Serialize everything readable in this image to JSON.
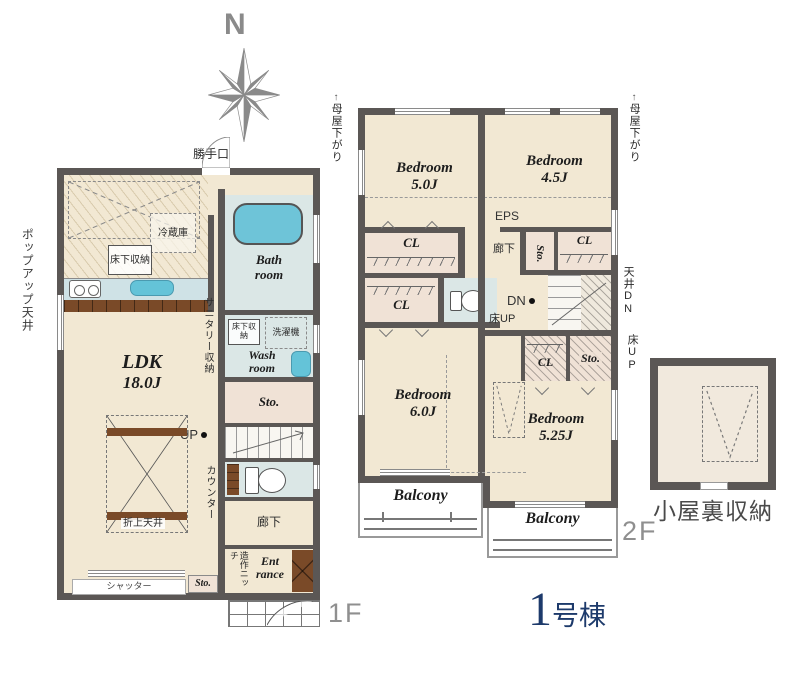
{
  "compass": {
    "north": "N"
  },
  "colors": {
    "wall": "#5b5755",
    "floor_cream": "#f2e8d3",
    "wet_area_blue": "#dbe7e6",
    "tub_blue": "#6ec4d8",
    "storage_beige": "#f0e2d6",
    "wood_brown": "#7a4a28",
    "building_navy": "#1d3a6b",
    "floor_label_gray": "#8f8f8f",
    "compass_gray": "#8a8a8a"
  },
  "floor1": {
    "floor_label": "1F",
    "kitchen": {
      "back_door": "勝手口",
      "refrigerator": "冷蔵庫",
      "underfloor_storage": "床下収納",
      "popup_ceiling": "ポップアップ天井"
    },
    "bath": {
      "line1": "Bath",
      "line2": "room"
    },
    "wash": {
      "line1": "Wash",
      "line2": "room",
      "washing_machine": "洗濯機",
      "underfloor_storage": "床下収納",
      "sanitary_storage": "サニタリー収納"
    },
    "storage_main": "Sto.",
    "ldk": {
      "name": "LDK",
      "size": "18.0J",
      "raised_ceiling": "折上天井",
      "counter": "カウンター",
      "shutter": "シャッター"
    },
    "stairs_up": "UP",
    "hallway": "廊下",
    "storage_small": "Sto.",
    "entrance": {
      "niche": "造作ニッチ",
      "line1": "Ent",
      "line2": "rance"
    }
  },
  "floor2": {
    "floor_label": "2F",
    "moya_left": "母屋下がり",
    "moya_right": "母屋下がり",
    "moya_arrow": "↑",
    "bedroom1": {
      "name": "Bedroom",
      "size": "5.0J"
    },
    "bedroom2": {
      "name": "Bedroom",
      "size": "4.5J"
    },
    "bedroom3": {
      "name": "Bedroom",
      "size": "6.0J"
    },
    "bedroom4": {
      "name": "Bedroom",
      "size": "5.25J"
    },
    "eps": "EPS",
    "closet1": "CL",
    "closet2": "CL",
    "closet3": "CL",
    "closet4": "CL",
    "storage_top": "Sto.",
    "storage_bottom": "Sto.",
    "hallway": "廊下",
    "stairs_down": "DN",
    "ceiling_down": "天井DN",
    "floor_up_left": "床UP",
    "floor_up_right": "床UP",
    "balcony_left": "Balcony",
    "balcony_right": "Balcony"
  },
  "attic": {
    "label": "小屋裏収納"
  },
  "building": {
    "number": "1",
    "suffix": "号棟"
  }
}
